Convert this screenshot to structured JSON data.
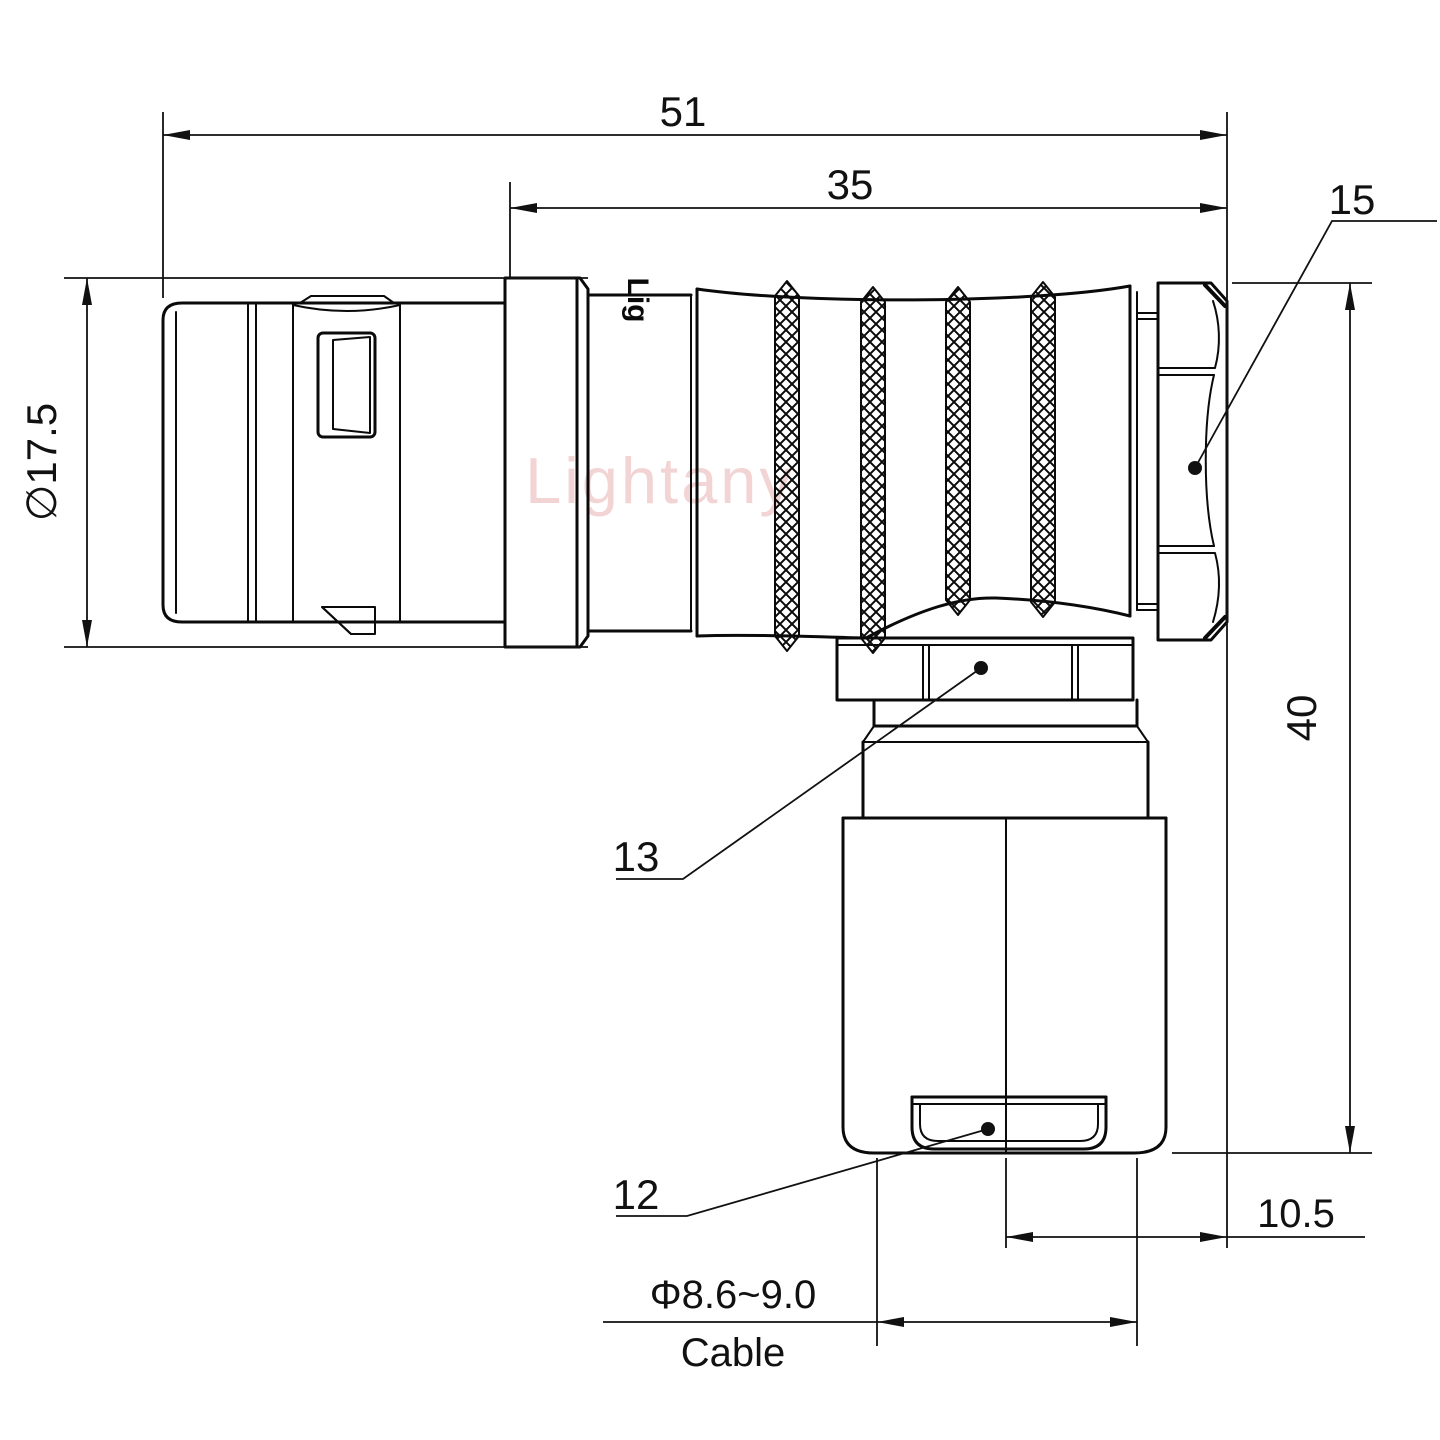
{
  "title": "Right-angle connector plug engineering drawing",
  "colors": {
    "background": "#ffffff",
    "line": "#0a0a0a",
    "watermark": "#f0c6c6"
  },
  "watermark": {
    "text": "Lightany"
  },
  "engraving": {
    "text": "Lig"
  },
  "dims": {
    "overall_length": "51",
    "body_length": "35",
    "coupling_nut_ref": "15",
    "front_diameter": "∅17.5",
    "height": "40",
    "offset": "10.5",
    "back_nut_ref": "13",
    "bushing_ref": "12",
    "cable_diameter": "Φ8.6~9.0",
    "cable_label": "Cable"
  }
}
